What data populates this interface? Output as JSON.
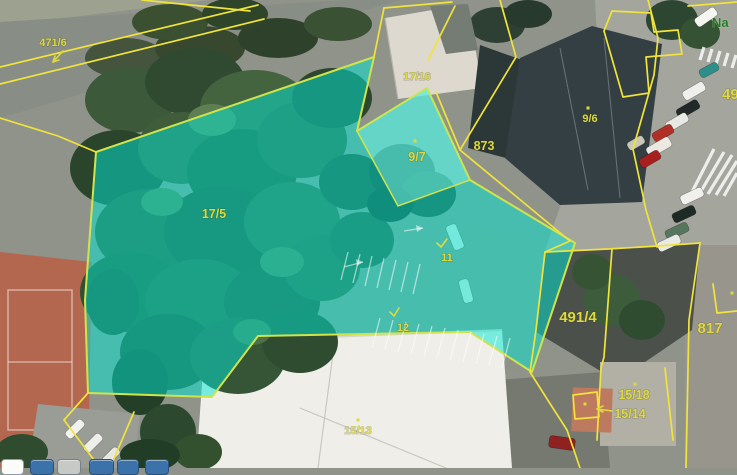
{
  "map": {
    "parcel_labels": [
      {
        "name": "parcel-471-6",
        "text": "471/6"
      },
      {
        "name": "parcel-17-16",
        "text": "17/16"
      },
      {
        "name": "parcel-9-7",
        "text": "9/7"
      },
      {
        "name": "parcel-873",
        "text": "873"
      },
      {
        "name": "parcel-17-5",
        "text": "17/5"
      },
      {
        "name": "parcel-9-6",
        "text": "9/6"
      },
      {
        "name": "parcel-11",
        "text": "11"
      },
      {
        "name": "parcel-12",
        "text": "12"
      },
      {
        "name": "parcel-491-4",
        "text": "491/4"
      },
      {
        "name": "parcel-817",
        "text": "817"
      },
      {
        "name": "parcel-49",
        "text": "49"
      },
      {
        "name": "parcel-15-18",
        "text": "15/18"
      },
      {
        "name": "parcel-15-14",
        "text": "15/14"
      },
      {
        "name": "parcel-15-13",
        "text": "15/13"
      }
    ],
    "street_label": {
      "text": "Na"
    },
    "highlight": {
      "parcels": [
        "17/5",
        "9/7",
        "11",
        "12"
      ]
    },
    "colors": {
      "parcel-line": "#f0e33c",
      "highlight": "#00e8d4",
      "highlight-light": "#8af2e4",
      "highlight-line": "#cfe44c",
      "label": "#ded93e",
      "street": "#237a23"
    }
  },
  "toolbar": {
    "buttons": [
      {
        "name": "map-tool-button-1",
        "color": "#fbfbf9"
      },
      {
        "name": "map-tool-button-2",
        "color": "#3c72aa"
      },
      {
        "name": "map-tool-button-3",
        "color": "#c7c9c6"
      },
      {
        "name": "map-tool-button-4",
        "color": "#3c72aa"
      },
      {
        "name": "map-tool-button-5",
        "color": "#3c72aa"
      },
      {
        "name": "map-tool-button-6",
        "color": "#3c72aa"
      }
    ]
  }
}
